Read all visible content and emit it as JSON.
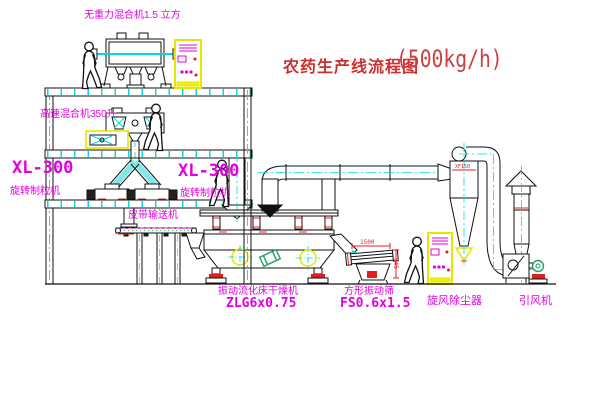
{
  "title": {
    "text": "农药生产线流程图",
    "capacity": "(500kg/h)"
  },
  "equipment_labels": {
    "gravity_mixer": "无重力混合机1.5 立方",
    "high_speed_mixer": "高速混合机350升",
    "granulator_left_model": "XL-300",
    "granulator_left_name": "旋转制粒机",
    "granulator_right_model": "XL-300",
    "granulator_right_name": "旋转制粒机",
    "belt_conveyor": "皮带输送机",
    "dryer_name": "振动流化床干燥机",
    "dryer_model": "ZLG6x0.75",
    "screen_name": "方形振动筛",
    "screen_model": "FS0.6x1.5",
    "cyclone": "旋风除尘器",
    "induced_draft_fan": "引风机"
  },
  "dimensions": {
    "screen_length": "1500",
    "screen_height": "545",
    "cyclone_tag": "XF150"
  },
  "colors": {
    "background": "#ffffff",
    "line_black": "#111111",
    "label_magenta": "#e100e1",
    "title_red": "#cc3030",
    "accent_red": "#e02020",
    "centerline_cyan": "#00dcdc",
    "cabinet_yellow": "#f0f000",
    "motor_green": "#1fa05f"
  }
}
